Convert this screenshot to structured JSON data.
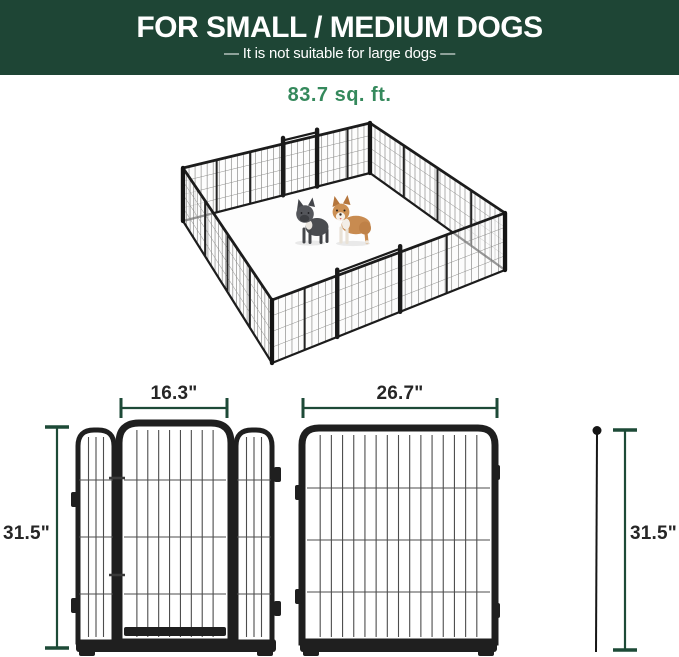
{
  "banner": {
    "title": "FOR SMALL / MEDIUM DOGS",
    "subtitle": "—  It is not suitable for large dogs  —"
  },
  "pen": {
    "area_label": "83.7 sq. ft.",
    "dogs": [
      "french-bulldog",
      "corgi"
    ]
  },
  "dimensions": {
    "door_width": "16.3\"",
    "panel_width": "26.7\"",
    "panel_height_left": "31.5\"",
    "panel_height_right": "31.5\""
  },
  "colors": {
    "banner_background": "#1e4535",
    "banner_text": "#ffffff",
    "area_label_green": "#35895c",
    "dimension_line_green": "#1d4a37",
    "label_text": "#262626",
    "metal_dark": "#1f1f1f",
    "wire_gray": "#4d4d4d"
  }
}
